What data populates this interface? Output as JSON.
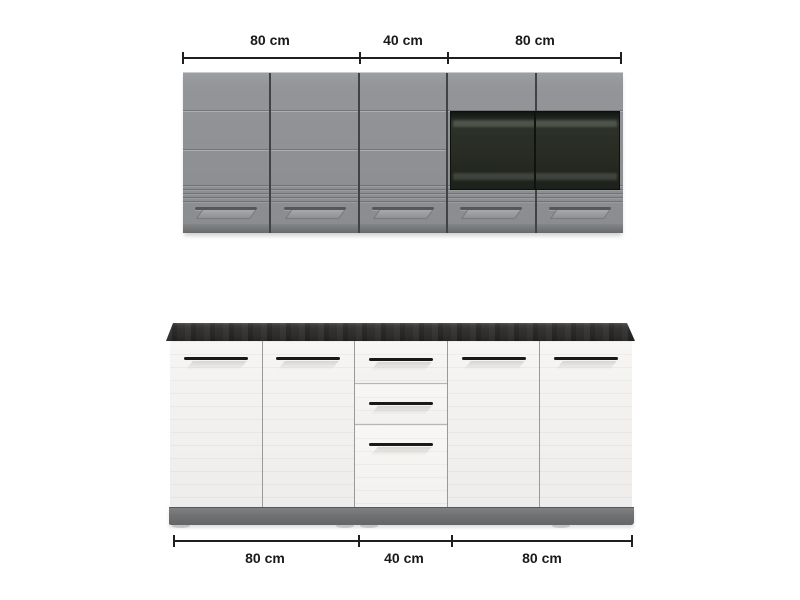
{
  "dimension_top": {
    "segments": [
      {
        "label": "80 cm"
      },
      {
        "label": "40 cm"
      },
      {
        "label": "80 cm"
      }
    ]
  },
  "dimension_bottom": {
    "segments": [
      {
        "label": "80 cm"
      },
      {
        "label": "40 cm"
      },
      {
        "label": "80 cm"
      }
    ]
  },
  "units": {
    "wall_row_door_count": 5,
    "wall_row_glass_door_count": 2,
    "base_row_door_count": 4,
    "base_row_drawer_count": 3
  },
  "colors": {
    "wall_cabinet_gray": "#8e9093",
    "glass_dark": "#23271e",
    "countertop_charcoal": "#2c2a28",
    "base_cabinet_white": "#f3f1ee",
    "plinth_gray": "#6f7172",
    "dimension_ink": "#1a1a1a",
    "background": "#ffffff"
  }
}
